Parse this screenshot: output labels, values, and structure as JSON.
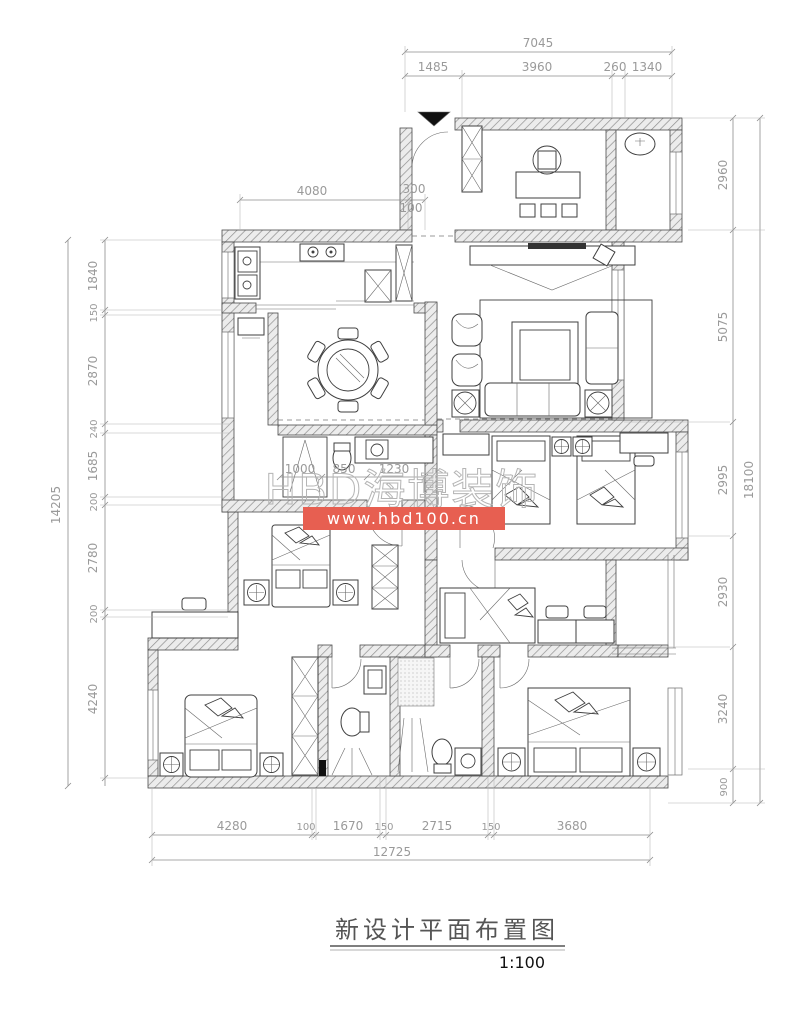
{
  "watermark": {
    "brand": "HBD海博装饰",
    "url": "www.hbd100.cn",
    "bar_color": "#e75f51",
    "brand_outline_color": "#b5b5b5"
  },
  "title_block": {
    "title": "新设计平面布置图",
    "scale": "1:100"
  },
  "dims": {
    "top_total": "7045",
    "top_segs": [
      "1485",
      "3960",
      "260",
      "1340"
    ],
    "upper_left": [
      "4080",
      "300",
      "100"
    ],
    "left_outer": "14205",
    "left_segs": [
      "1840",
      "150",
      "2870",
      "240",
      "1685",
      "200",
      "2780",
      "200",
      "4240"
    ],
    "right_outer": "18100",
    "right_segs": [
      "2960",
      "5075",
      "2995",
      "2930",
      "3240",
      "900"
    ],
    "bottom_total": "12725",
    "bottom_segs": [
      "4280",
      "100",
      "1670",
      "150",
      "2715",
      "150",
      "3680"
    ],
    "bath_segs": [
      "1000",
      "850",
      "1230"
    ]
  }
}
